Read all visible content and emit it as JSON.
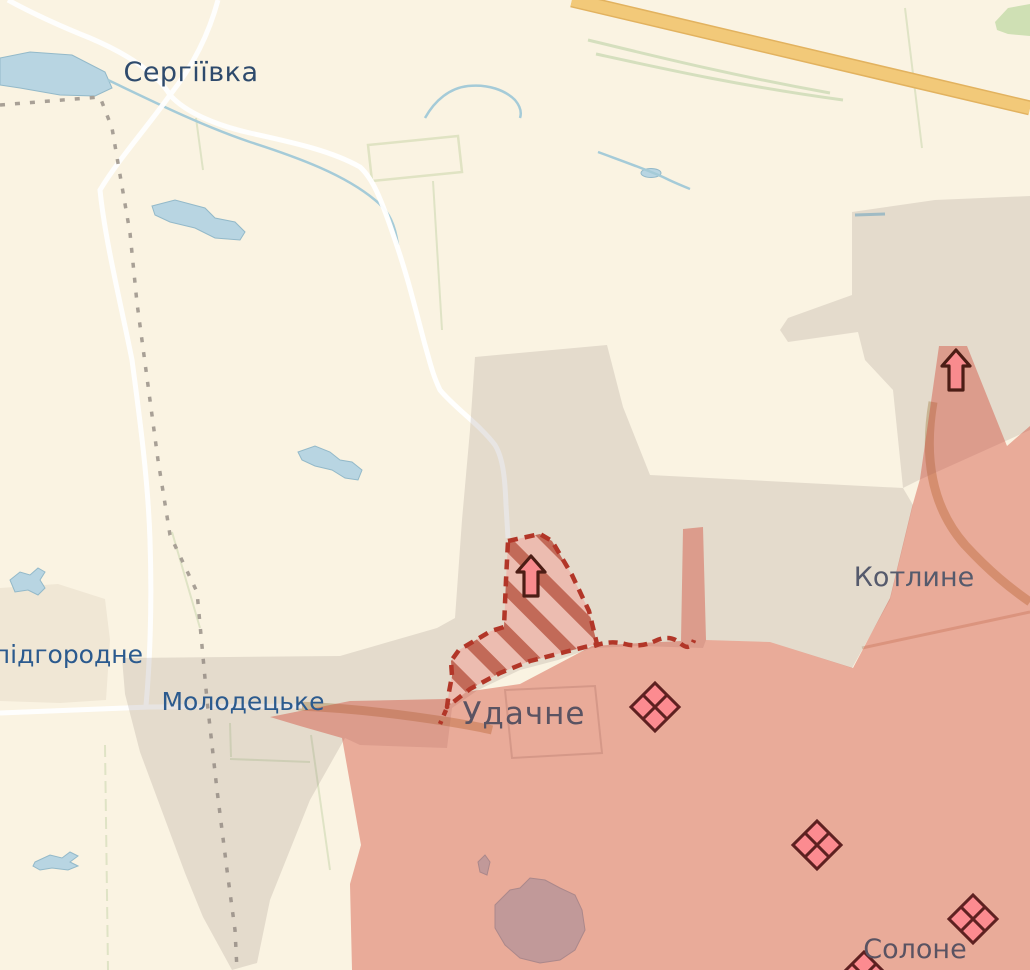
{
  "map": {
    "settlement_labels": {
      "serhiivka": "Сергіївка",
      "novopidhorodne_partial": "опідгородне",
      "molodetske": "Молодецьке",
      "udachne": "Удачне",
      "kotlyne": "Котлине",
      "solone": "Солоне"
    },
    "zones": {
      "background": "#faf3e2",
      "contested_grey_overlay": "rgba(140,125,120,0.20)",
      "occupied_red_overlay": "rgba(208,62,45,0.40)",
      "advance_area_light": "#ecbcb0",
      "advance_area_stripe": "#c26a58",
      "advance_outline_red": "#b23628"
    },
    "base_colors": {
      "water": "#b8d5e2",
      "highway_yellow": "#f2c979",
      "road_white": "#ffffff",
      "road_tan": "#d9c49c",
      "field_green": "#d5dfbe",
      "admin_dash_grey": "#a8a096"
    },
    "icons": {
      "attack_arrow_color": "#f98b8e",
      "attack_arrow_outline": "#4c1d15",
      "diamond_color": "#fc8b90",
      "diamond_outline": "#5e2121",
      "attack_arrow_count": 2,
      "diamond_count": 4
    }
  }
}
